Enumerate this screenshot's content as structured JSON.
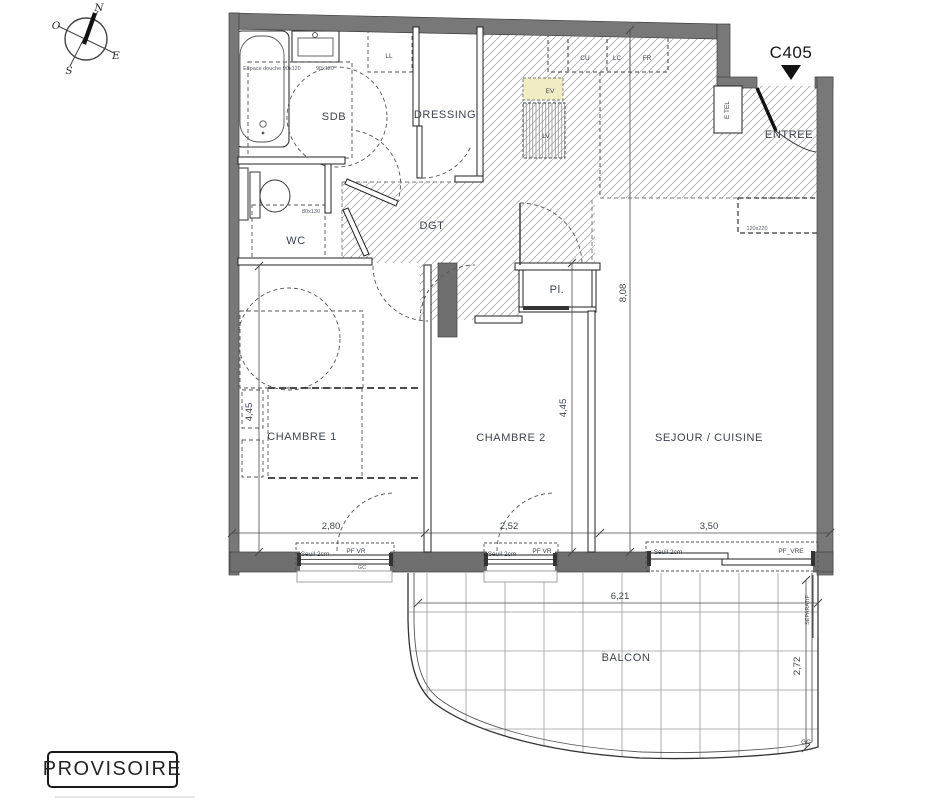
{
  "plan": {
    "code": "C405",
    "stamp": "PROVISOIRE",
    "rooms": {
      "sdb": "SDB",
      "dressing": "DRESSING",
      "wc": "WC",
      "dgt": "DGT",
      "entree": "ENTREE",
      "placard": "Pl.",
      "chambre1": "CHAMBRE 1",
      "chambre2": "CHAMBRE 2",
      "sejour": "SEJOUR / CUISINE",
      "balcon": "BALCON"
    },
    "fixtures": {
      "ll": "LL",
      "cu": "CU",
      "lc": "LC",
      "fr": "FR",
      "ev": "EV",
      "lv": "LV",
      "etel": "E TEL"
    },
    "annotations": {
      "espace_douche": "Espace douche 90x120",
      "douche_dim": "90x120",
      "wc_dim": "80x130",
      "sejour_niche_dim": "120x220",
      "seuil": "Seuil 2cm",
      "pf_vr": "PF VR",
      "pf_vre": "PF_VRE",
      "gc": "GC",
      "separatif": "SEPARATIF"
    },
    "dimensions": {
      "ch1_w": "2,80",
      "ch2_w": "2,52",
      "sejour_w": "3,50",
      "ch1_h": "4,45",
      "ch2_h": "4,45",
      "sejour_h": "8,08",
      "balcon_w": "6,21",
      "balcon_h": "2,72"
    },
    "compass": {
      "n": "N",
      "e": "E",
      "s": "S",
      "o": "O"
    }
  }
}
